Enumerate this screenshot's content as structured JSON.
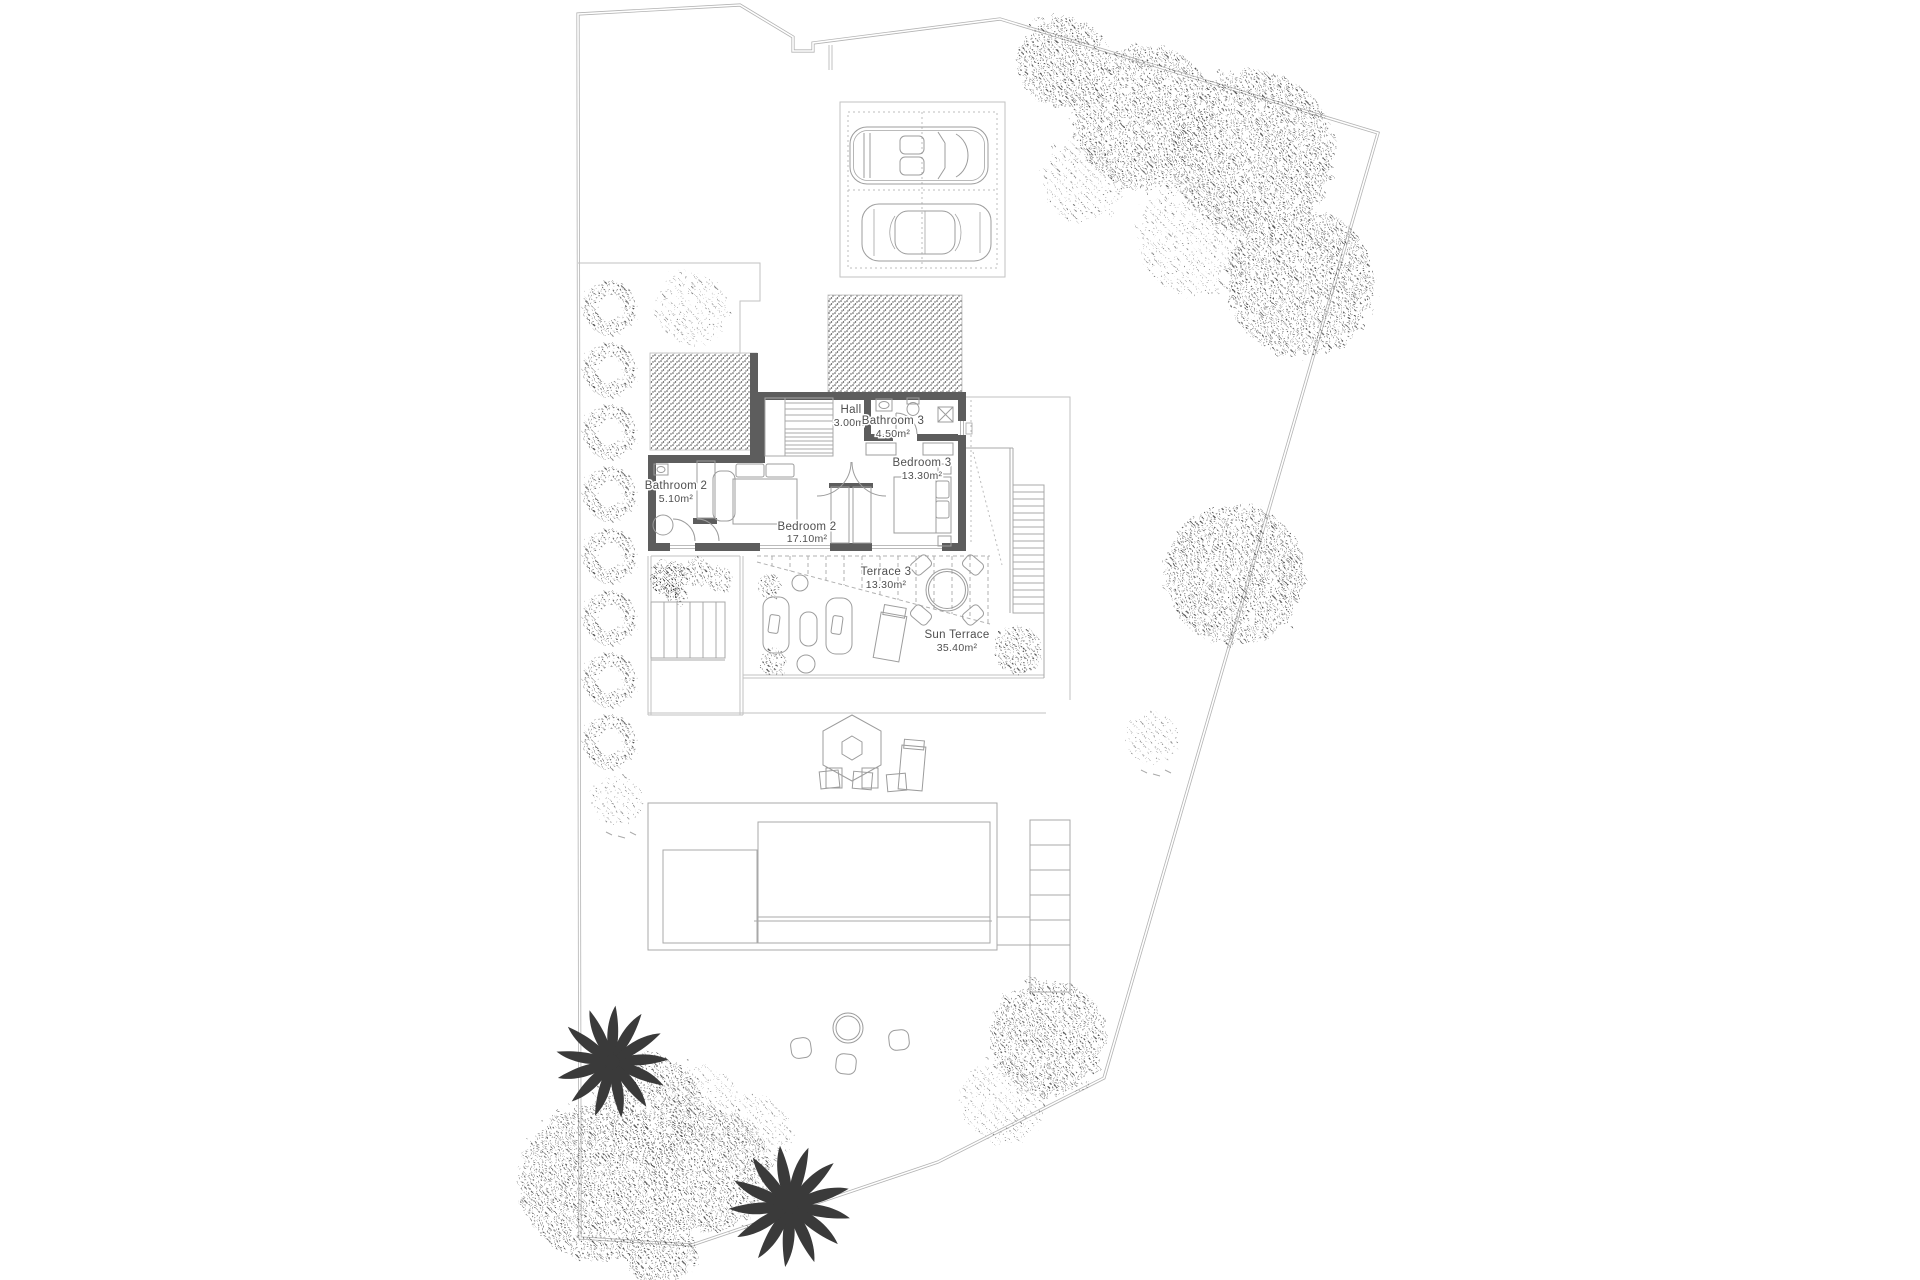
{
  "rooms": [
    {
      "name": "Hall",
      "area": "3.00m²"
    },
    {
      "name": "Bathroom 3",
      "area": "4.50m²"
    },
    {
      "name": "Bedroom 3",
      "area": "13.30m²"
    },
    {
      "name": "Bathroom 2",
      "area": "5.10m²"
    },
    {
      "name": "Bedroom 2",
      "area": "17.10m²"
    },
    {
      "name": "Terrace 3",
      "area": "13.30m²"
    },
    {
      "name": "Sun Terrace",
      "area": "35.40m²"
    }
  ],
  "colors": {
    "background": "#ffffff",
    "wall": "#5d5d5d",
    "boundary": "#b3b3b3",
    "thin_line": "#c2c2c2",
    "furniture_line": "#9c9c9c",
    "foliage_dot": "#4f4f4f",
    "palm": "#3a3a3a",
    "label_text": "#4f4f4f"
  }
}
